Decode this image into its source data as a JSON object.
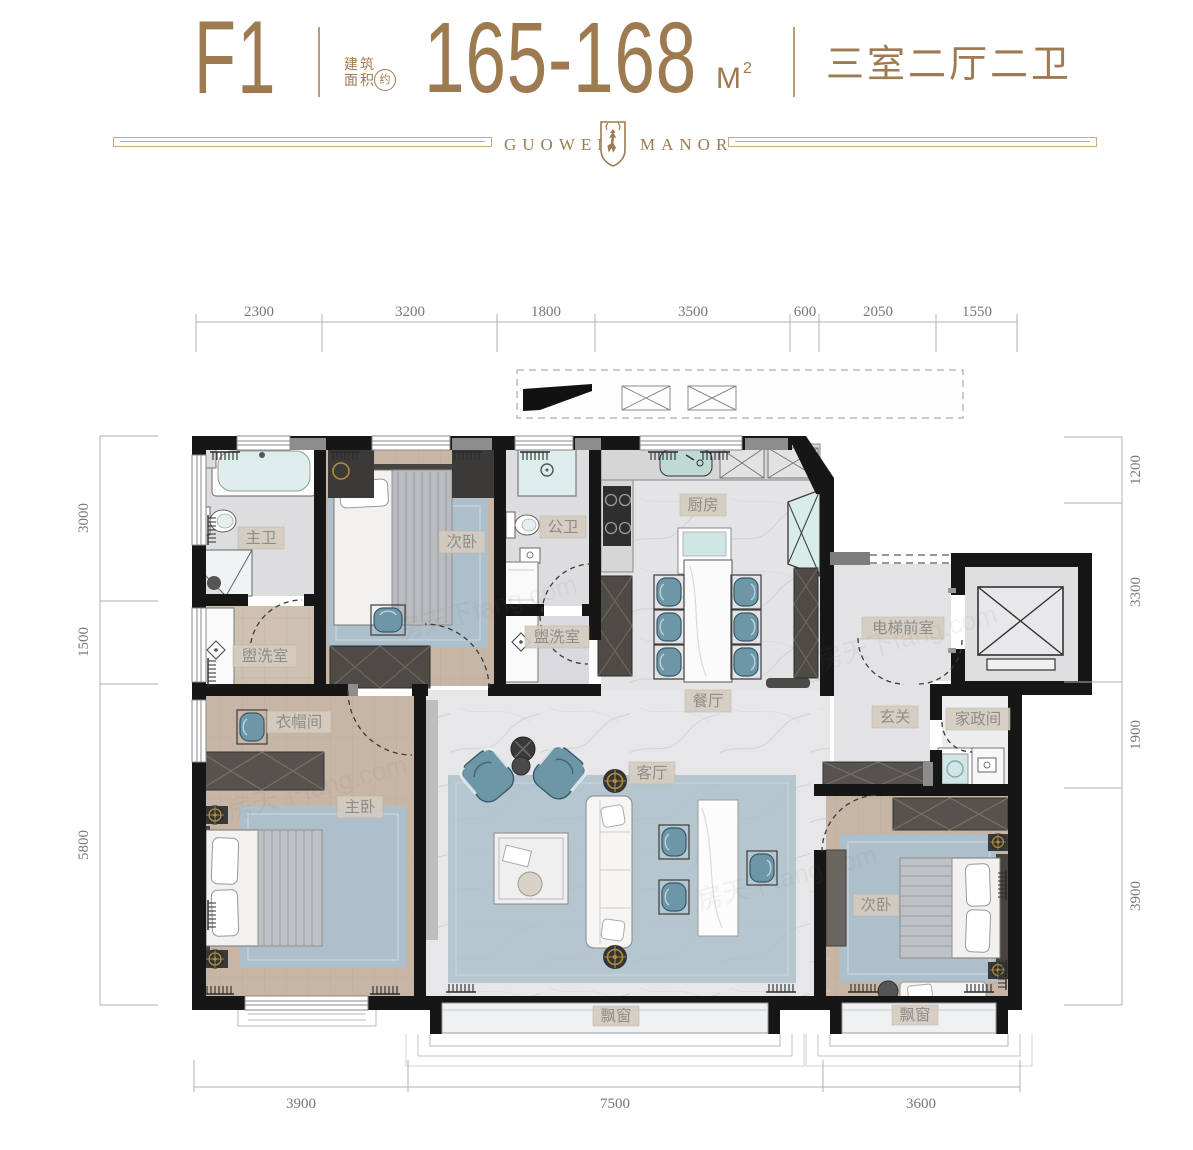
{
  "header": {
    "unit_code": "F1",
    "area_prefix_line1": "建筑",
    "area_prefix_line2": "面积",
    "area_approx": "约",
    "area_value": "165-168",
    "area_unit": "M",
    "area_unit_exp": "2",
    "layout_text": "三室二厅二卫"
  },
  "logo": {
    "name_left": "GUOWEN",
    "name_right": "MANOR"
  },
  "watermark": "房天下fang.com",
  "dimensions": {
    "top": [
      "2300",
      "3200",
      "1800",
      "3500",
      "600",
      "2050",
      "1550"
    ],
    "left": [
      "3000",
      "1500",
      "5800"
    ],
    "right": [
      "1200",
      "3300",
      "1900",
      "3900"
    ],
    "bottom": [
      "3900",
      "7500",
      "3600"
    ]
  },
  "rooms": [
    {
      "id": "master-bath",
      "label": "主卫"
    },
    {
      "id": "bedroom-2",
      "label": "次卧"
    },
    {
      "id": "public-bath",
      "label": "公卫"
    },
    {
      "id": "washroom-left",
      "label": "盥洗室"
    },
    {
      "id": "washroom-right",
      "label": "盥洗室"
    },
    {
      "id": "kitchen",
      "label": "厨房"
    },
    {
      "id": "dining-room",
      "label": "餐厅"
    },
    {
      "id": "elevator-hall",
      "label": "电梯前室"
    },
    {
      "id": "foyer",
      "label": "玄关"
    },
    {
      "id": "housekeeping-room",
      "label": "家政间"
    },
    {
      "id": "cloakroom",
      "label": "衣帽间"
    },
    {
      "id": "master-bedroom",
      "label": "主卧"
    },
    {
      "id": "living-room",
      "label": "客厅"
    },
    {
      "id": "bedroom-3",
      "label": "次卧"
    },
    {
      "id": "bay-window-left",
      "label": "飘窗"
    },
    {
      "id": "bay-window-right",
      "label": "飘窗"
    }
  ],
  "colors": {
    "accent_brown": "#9e7a50",
    "wall_black": "#161616",
    "teal_furniture": "#6d97a7",
    "wood_floor": "#c7b6a5",
    "marble_floor": "#e5e5e8",
    "rug_blue": "#adbfca",
    "dim_text": "#777777",
    "label_bg": "#d5ccbf",
    "label_text": "#8d8d8d"
  }
}
